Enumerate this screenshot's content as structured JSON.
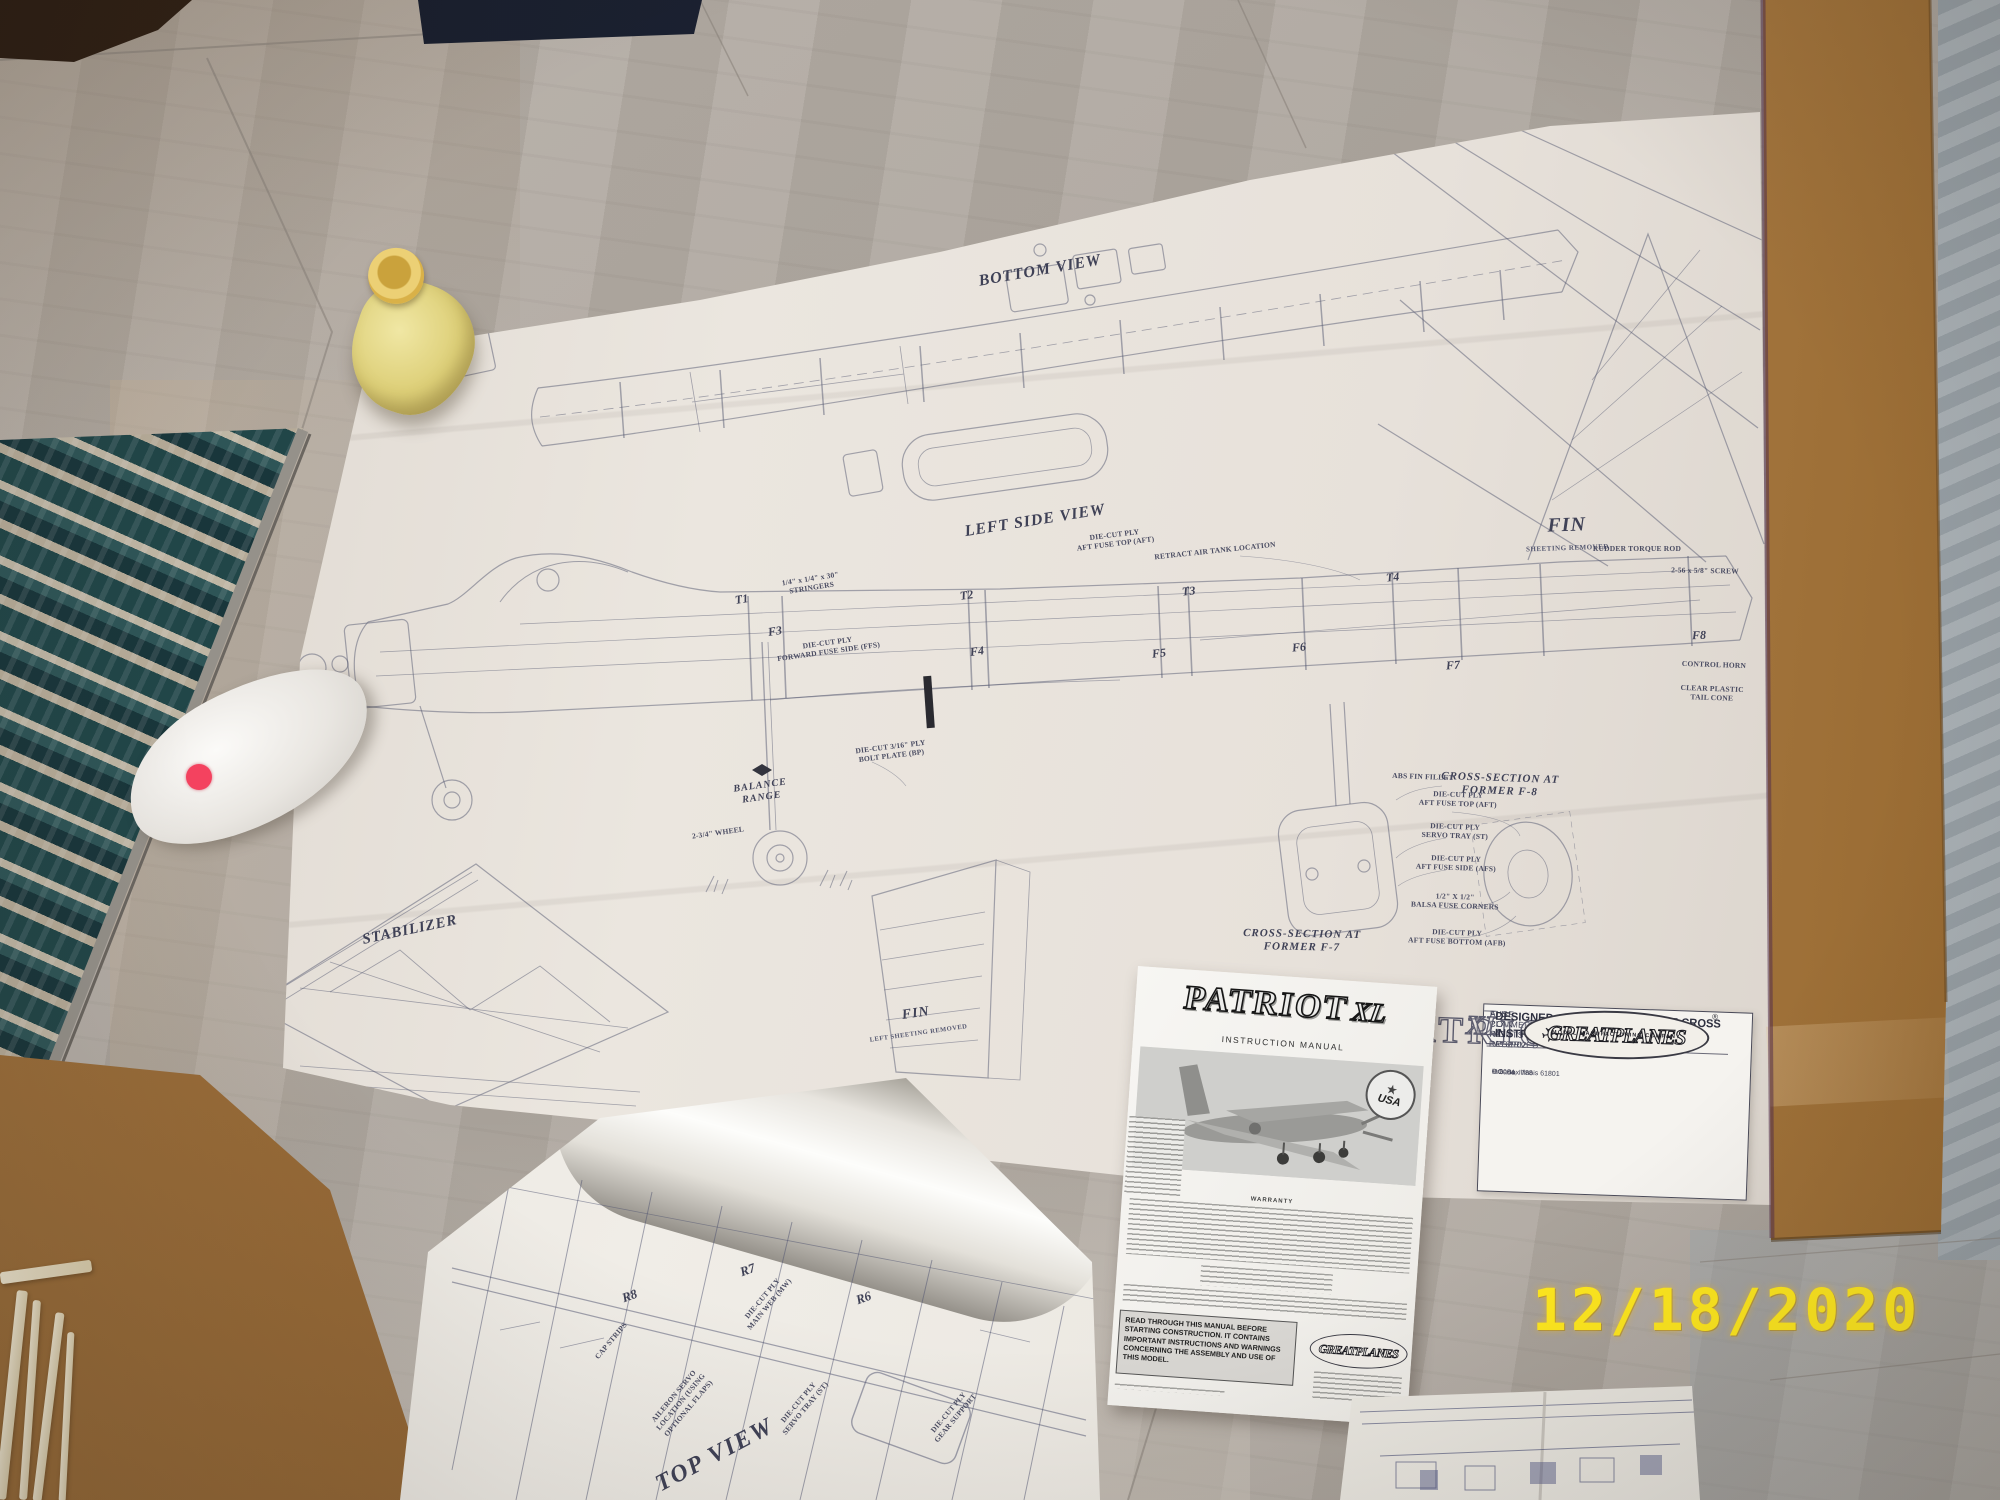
{
  "scene": {
    "date_stamp": "12/18/2020"
  },
  "colors": {
    "floor_base": "#b1aaa2",
    "floor_cool": "#9ea6ab",
    "cardboard": "#a5763f",
    "rug_teal": "#1d4649",
    "rug_cream": "#cbbfa8",
    "plan_paper": "#e9e3dc",
    "bright_paper": "#f6f4f0",
    "ink": "#4e5268",
    "date_yellow": "#ffe81e",
    "bottle_yellow": "#e7d87d",
    "sticker_pink": "#f4425f",
    "wood_dark": "#332318",
    "mat_navy": "#1b2130"
  },
  "plan": {
    "views": {
      "bottom_view": "BOTTOM VIEW",
      "left_side_view": "LEFT SIDE VIEW",
      "fin": "FIN",
      "fin_sub": "SHEETING REMOVED",
      "fin2": "FIN",
      "fin2_sub": "LEFT SHEETING REMOVED",
      "stabilizer": "STABILIZER",
      "balance": "BALANCE\nRANGE",
      "cs_f7": "CROSS-SECTION AT\nFORMER F-7",
      "cs_f8": "CROSS-SECTION AT\nFORMER F-8"
    },
    "formers_top": [
      "T1",
      "T2",
      "T3",
      "T4"
    ],
    "formers_side": [
      "F3",
      "F4",
      "F5",
      "F6",
      "F7",
      "F8"
    ],
    "callouts": [
      "ABS FIN FILLET",
      "DIE-CUT PLY\nAFT FUSE TOP (AFT)",
      "DIE-CUT PLY\nSERVO TRAY (ST)",
      "DIE-CUT PLY\nAFT FUSE SIDE (AFS)",
      "1/2\" X 1/2\"\nBALSA FUSE CORNERS",
      "DIE-CUT PLY\nAFT FUSE BOTTOM (AFB)",
      "RETRACT AIR TANK LOCATION",
      "DIE-CUT PLY\nAFT FUSE TOP (AFT)",
      "1/4\" x 1/4\" x 30\"\nSTRINGERS",
      "DIE-CUT PLY\nFORWARD FUSE SIDE (FFS)",
      "RUDDER TORQUE ROD",
      "2-56 x 5/8\" SCREW",
      "CONTROL HORN",
      "CLEAR PLASTIC\nTAIL CONE",
      "2-3/4\" WHEEL",
      "DIE-CUT 3/16\" PLY\nBOLT PLATE (BP)"
    ],
    "title_block": {
      "rights": "ALL COMMERCIAL RIGHTS RESERVED",
      "plan_no": "FUSE PLAN No. PAT6P02",
      "title": "PATRIOT",
      "title_suffix": "XL",
      "credits": "DESIGNED AND DRAWN BY: MIKE CROSS\nINSTRUCTIONS BY: ROBERT MANNING",
      "brand": "GREATPLANES",
      "reg": "®",
      "brand_sub": "MODEL MANUFACTURING COMPANY",
      "copyright": "© 2004",
      "po_box": "P.O. Box 788",
      "city": "Urbana, Illinois 61801"
    }
  },
  "manual": {
    "title": "PATRIOT",
    "title_suffix": "XL",
    "subtitle": "INSTRUCTION MANUAL",
    "badge_star": "★",
    "badge": "USA",
    "warranty_heading": "WARRANTY",
    "warning": "READ THROUGH THIS MANUAL BEFORE STARTING CONSTRUCTION. IT CONTAINS IMPORTANT INSTRUCTIONS AND WARNINGS CONCERNING THE ASSEMBLY AND USE OF THIS MODEL.",
    "brand": "GREATPLANES"
  },
  "wing_sheet": {
    "ribs": [
      "R8",
      "R7",
      "R6"
    ],
    "view_label": "TOP VIEW",
    "callouts": [
      "CAP STRIPS",
      "DIE-CUT PLY\nMAIN WEB (MW)",
      "AILERON SERVO\nLOCATION (USING\nOPTIONAL FLAPS)",
      "DIE-CUT PLY\nSERVO TRAY (ST)",
      "DIE-CUT PLY\nGEAR SUPPORT"
    ]
  }
}
